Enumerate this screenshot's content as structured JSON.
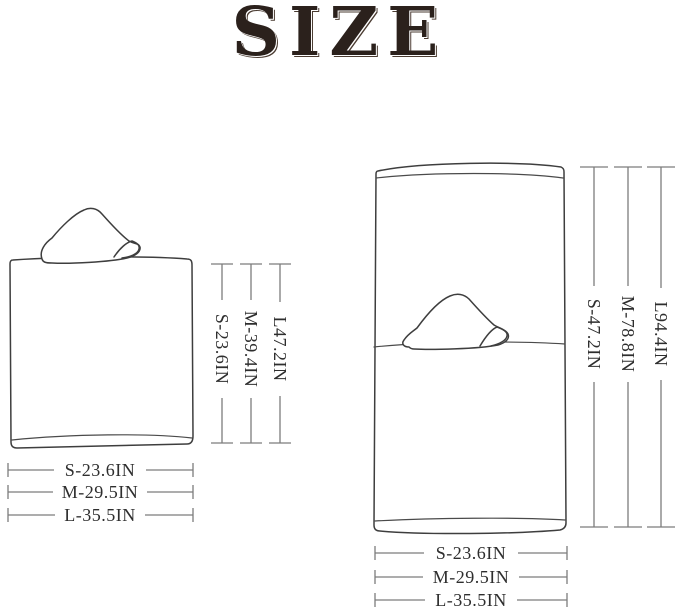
{
  "title": "SIZE",
  "colors": {
    "background": "#ffffff",
    "title_text": "#2b211c",
    "line_art": "#3e3e3e",
    "dimension_lines": "#7c7c7c",
    "label_text": "#2e2e2e"
  },
  "folded": {
    "figure": "folded-hooded-towel",
    "height_labels": [
      "S-23.6IN",
      "M-39.4IN",
      "L47.2IN"
    ],
    "width_labels": [
      "S-23.6IN",
      "M-29.5IN",
      "L-35.5IN"
    ]
  },
  "unfolded": {
    "figure": "unfolded-hooded-towel",
    "height_labels": [
      "S-47.2IN",
      "M-78.8IN",
      "L94.4IN"
    ],
    "width_labels": [
      "S-23.6IN",
      "M-29.5IN",
      "L-35.5IN"
    ]
  }
}
